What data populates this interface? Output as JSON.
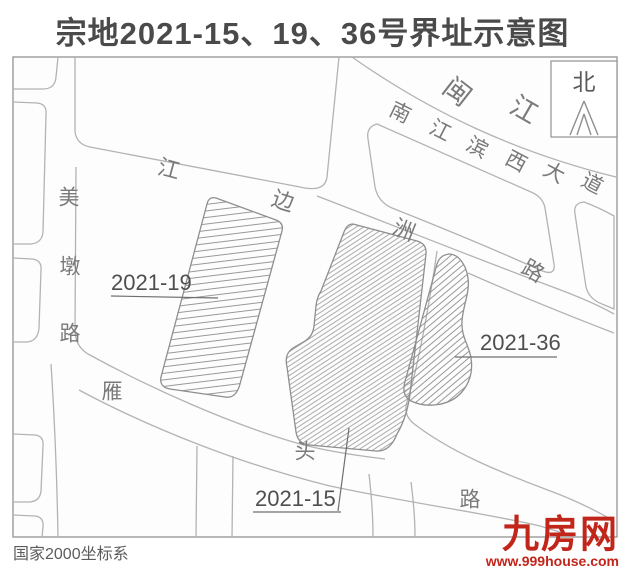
{
  "title": "宗地2021-15、19、36号界址示意图",
  "compass": {
    "label": "北"
  },
  "coordinate_note": "国家2000坐标系",
  "watermark": {
    "logo": "九房网",
    "url": "www.999house.com"
  },
  "colors": {
    "road_line": "#b3b3b3",
    "parcel_line": "#8f8f8f",
    "hatch": "#8d8d8d",
    "label_dark": "#4f4f4f",
    "label_road": "#7a7a7a",
    "logo_red": "#c2251a"
  },
  "map": {
    "road_labels": [
      {
        "name": "minjiang-river",
        "chars": [
          {
            "t": "闽",
            "x": 457,
            "y": 92,
            "r": 38,
            "s": 27
          },
          {
            "t": "江",
            "x": 524,
            "y": 110,
            "r": 30,
            "s": 27
          }
        ]
      },
      {
        "name": "nanjiangbin-west-avenue",
        "chars": [
          {
            "t": "南",
            "x": 400,
            "y": 113,
            "r": 26,
            "s": 21
          },
          {
            "t": "江",
            "x": 440,
            "y": 131,
            "r": 27,
            "s": 21
          },
          {
            "t": "滨",
            "x": 477,
            "y": 148,
            "r": 28,
            "s": 21
          },
          {
            "t": "西",
            "x": 516,
            "y": 162,
            "r": 28,
            "s": 21
          },
          {
            "t": "大",
            "x": 554,
            "y": 173,
            "r": 28,
            "s": 21
          },
          {
            "t": "道",
            "x": 592,
            "y": 184,
            "r": 28,
            "s": 21
          }
        ]
      },
      {
        "name": "jiangbian-zhou-road",
        "chars": [
          {
            "t": "江",
            "x": 169,
            "y": 169,
            "r": 15,
            "s": 22
          },
          {
            "t": "边",
            "x": 283,
            "y": 201,
            "r": 18,
            "s": 22
          },
          {
            "t": "洲",
            "x": 404,
            "y": 230,
            "r": 22,
            "s": 22
          },
          {
            "t": "路",
            "x": 533,
            "y": 271,
            "r": 30,
            "s": 22
          }
        ]
      },
      {
        "name": "meidun-road",
        "chars": [
          {
            "t": "美",
            "x": 69,
            "y": 198,
            "r": 0,
            "s": 21
          },
          {
            "t": "墩",
            "x": 70,
            "y": 267,
            "r": 0,
            "s": 21
          },
          {
            "t": "路",
            "x": 70,
            "y": 334,
            "r": 0,
            "s": 21
          }
        ]
      },
      {
        "name": "yantou-road",
        "chars": [
          {
            "t": "雁",
            "x": 112,
            "y": 392,
            "r": 0,
            "s": 21
          },
          {
            "t": "头",
            "x": 305,
            "y": 452,
            "r": 0,
            "s": 21
          },
          {
            "t": "路",
            "x": 470,
            "y": 500,
            "r": 0,
            "s": 21
          }
        ]
      }
    ],
    "parcels": [
      {
        "id": "2021-19",
        "label": "2021-19"
      },
      {
        "id": "2021-15",
        "label": "2021-15"
      },
      {
        "id": "2021-36",
        "label": "2021-36"
      }
    ]
  }
}
